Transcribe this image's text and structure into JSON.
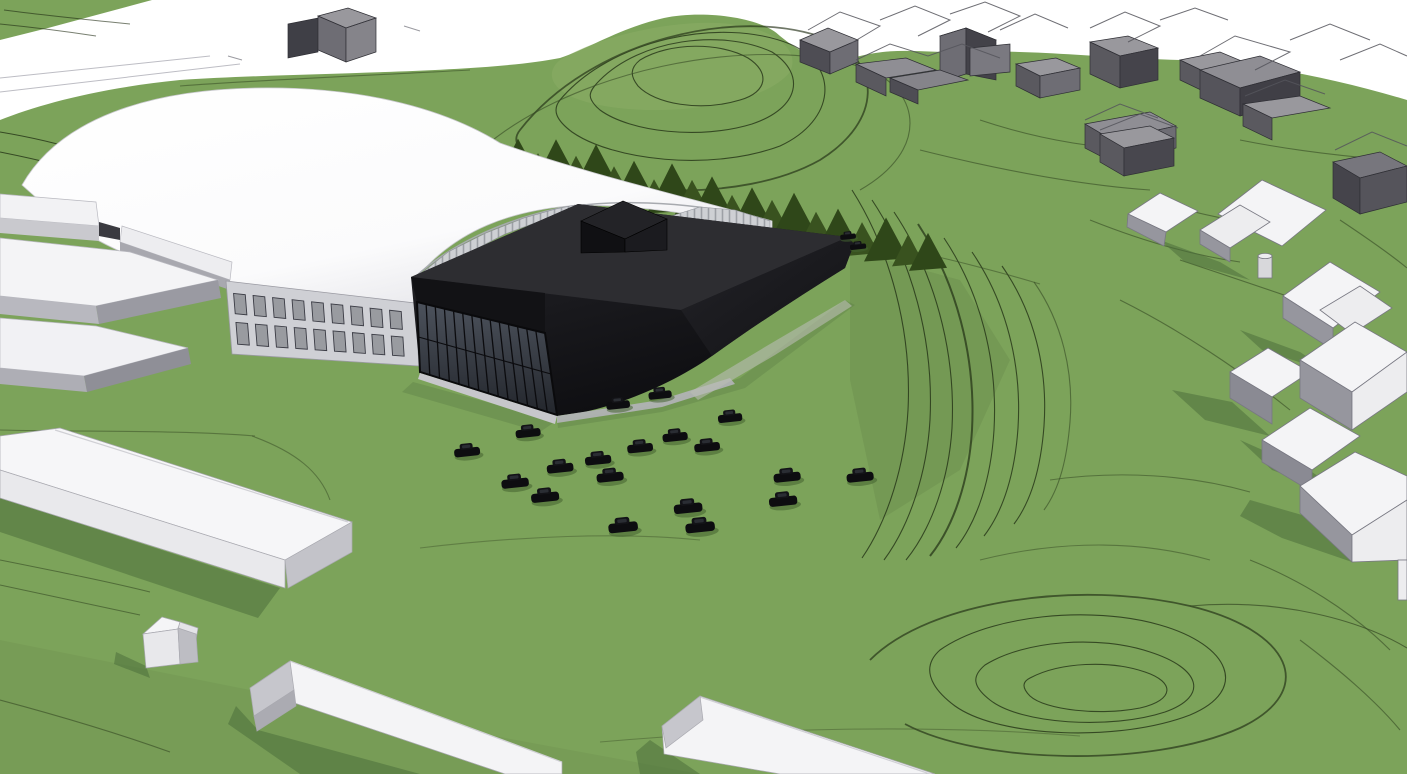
{
  "meta": {
    "description": "Aerial 3D architectural massing visualization: existing white barrel-vault sports hall with a new black extension building (glass front facade and rooftop plant box), black cars parked on the green in front, conifer tree row on the hillside behind, gray context buildings with wireframe rooflines on the upper slope, white neighbouring houses, and green terrain criss-crossed by topographic contour lines.",
    "view": "aerial perspective massing model"
  },
  "palette": {
    "sky": "#ffffff",
    "grass": "#7CA35A",
    "grass_shadow": "#4d6f3d",
    "contour": "#1e2b12",
    "conifer_dark": "#2f4719",
    "conifer_light": "#39521f",
    "dome_white": "#fbfbfc",
    "extension_black": "#17171a",
    "extension_roof": "#2d2d31",
    "glass": "#434851",
    "context_gray": "#6e6d74",
    "house_white": "#f4f4f6",
    "house_shade": "#96969e",
    "car_black": "#0d0d10"
  },
  "scene": {
    "existing_hall": {
      "label": "existing sports hall — white barrel-vault dome with windowed base wing"
    },
    "extension": {
      "label": "new extension — black volume with glass curtain wall and rooftop plant box"
    },
    "context": {
      "gray_buildings_label": "context buildings (gray massing with wireframe rooflines)",
      "white_houses_label": "neighbouring houses (white massing)",
      "farm_buildings_label": "long white outbuildings (foreground)"
    },
    "contours": {
      "label": "terrain contour lines"
    },
    "trees": {
      "label": "conifer tree row on hillside",
      "count": 21,
      "items": [
        [
          518,
          40
        ],
        [
          538,
          30
        ],
        [
          556,
          48
        ],
        [
          576,
          36
        ],
        [
          596,
          52
        ],
        [
          614,
          34
        ],
        [
          634,
          44
        ],
        [
          654,
          30
        ],
        [
          672,
          50
        ],
        [
          692,
          38
        ],
        [
          712,
          46
        ],
        [
          732,
          32
        ],
        [
          752,
          44
        ],
        [
          772,
          36
        ],
        [
          794,
          48
        ],
        [
          816,
          34
        ],
        [
          838,
          42
        ],
        [
          862,
          34
        ],
        [
          886,
          44
        ],
        [
          908,
          32
        ],
        [
          928,
          38
        ]
      ]
    },
    "cars": {
      "label": "parked black cars",
      "count": 21,
      "positions": [
        [
          618,
          404
        ],
        [
          660,
          394
        ],
        [
          730,
          417
        ],
        [
          528,
          432
        ],
        [
          675,
          436
        ],
        [
          707,
          446
        ],
        [
          467,
          451
        ],
        [
          640,
          447
        ],
        [
          598,
          459
        ],
        [
          560,
          467
        ],
        [
          610,
          476
        ],
        [
          515,
          482
        ],
        [
          545,
          496
        ],
        [
          787,
          476
        ],
        [
          860,
          476
        ],
        [
          783,
          500
        ],
        [
          688,
          507
        ],
        [
          700,
          526
        ],
        [
          623,
          526
        ],
        [
          848,
          236
        ],
        [
          858,
          246
        ]
      ]
    },
    "facade_band": {
      "tl": [
        226,
        281
      ],
      "tr": [
        415,
        303
      ],
      "br": [
        419,
        366
      ],
      "bl": [
        232,
        354
      ],
      "cols": 9
    }
  }
}
